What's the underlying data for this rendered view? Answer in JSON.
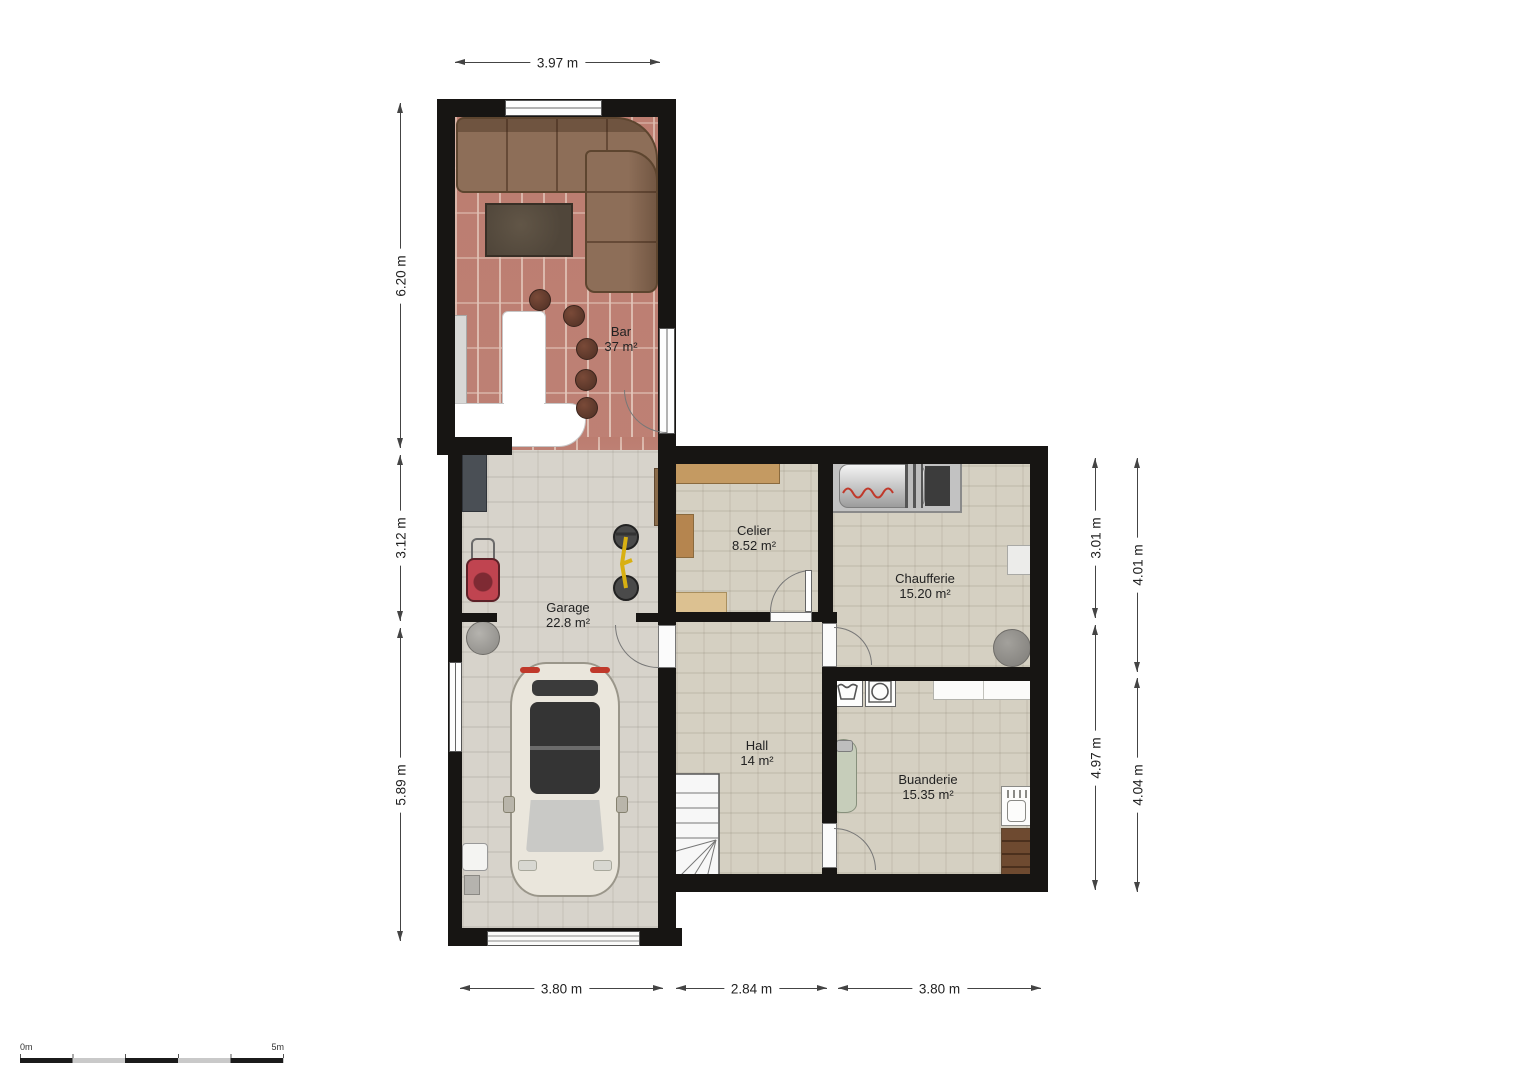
{
  "rooms": [
    {
      "name": "Bar",
      "area": "37 m²"
    },
    {
      "name": "Garage",
      "area": "22.8 m²"
    },
    {
      "name": "Celier",
      "area": "8.52 m²"
    },
    {
      "name": "Chaufferie",
      "area": "15.20 m²"
    },
    {
      "name": "Hall",
      "area": "14 m²"
    },
    {
      "name": "Buanderie",
      "area": "15.35 m²"
    }
  ],
  "dimensions": {
    "top": "3.97 m",
    "left": [
      "6.20 m",
      "3.12 m",
      "5.89 m"
    ],
    "right_inner": [
      "3.01 m",
      "4.97 m"
    ],
    "right_outer": [
      "4.01 m",
      "4.04 m"
    ],
    "bottom": [
      "3.80 m",
      "2.84 m",
      "3.80 m"
    ]
  },
  "scale_bar": {
    "start": "0m",
    "end": "5m"
  },
  "colors": {
    "wall": "#171513",
    "bar_floor_brick": "#c28579",
    "garage_floor": "#d7d3cb",
    "basement_floor": "#d5d0c2",
    "sofa": "#8d6e58",
    "wood_shelf": "#c49a62",
    "car_body": "#eae6dc",
    "accent_red": "#c0392b"
  }
}
